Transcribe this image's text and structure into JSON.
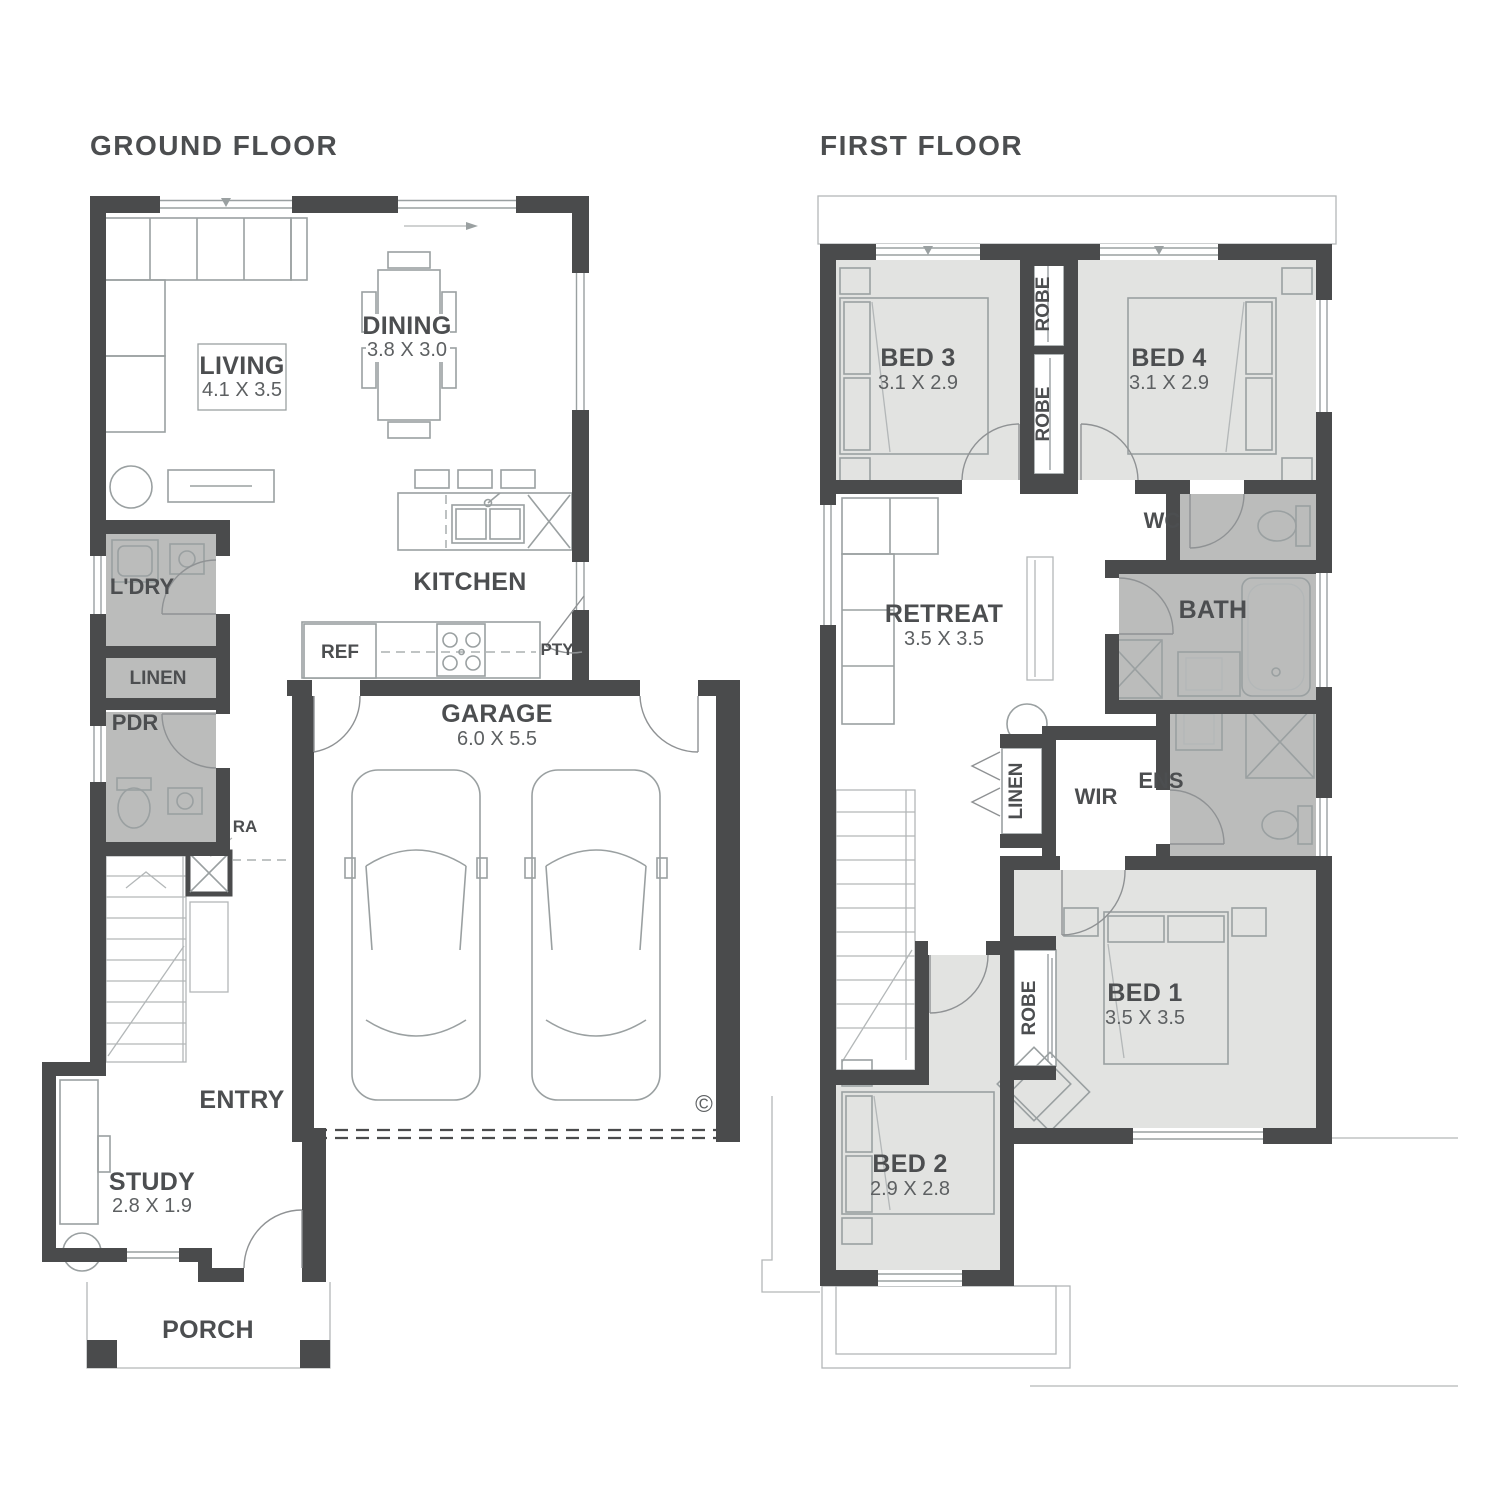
{
  "palette": {
    "wall": "#4a4b4c",
    "room-light": "#e2e3e1",
    "room-wet": "#bbbcbb",
    "line": "#9aa0a1",
    "thin": "#b3b7b8",
    "door": "#8f9294",
    "text": "#4c4e50",
    "text-light": "#5d6062",
    "bg": "#ffffff"
  },
  "ground_floor": {
    "title": "GROUND FLOOR",
    "rooms": {
      "living": {
        "name": "LIVING",
        "dims": "4.1 X 3.5"
      },
      "dining": {
        "name": "DINING",
        "dims": "3.8 X 3.0"
      },
      "kitchen": {
        "name": "KITCHEN"
      },
      "laundry": {
        "name": "L'DRY"
      },
      "linen": {
        "name": "LINEN"
      },
      "powder": {
        "name": "PDR"
      },
      "return_air": {
        "name": "RA"
      },
      "fridge": {
        "name": "REF"
      },
      "pantry": {
        "name": "PTY"
      },
      "garage": {
        "name": "GARAGE",
        "dims": "6.0 X 5.5"
      },
      "entry": {
        "name": "ENTRY"
      },
      "study": {
        "name": "STUDY",
        "dims": "2.8 X 1.9"
      },
      "porch": {
        "name": "PORCH"
      }
    },
    "copyright_mark": "©"
  },
  "first_floor": {
    "title": "FIRST FLOOR",
    "rooms": {
      "bed3": {
        "name": "BED 3",
        "dims": "3.1 X 2.9"
      },
      "bed4": {
        "name": "BED 4",
        "dims": "3.1 X 2.9"
      },
      "robe_bed3": {
        "name": "ROBE"
      },
      "robe_bed4": {
        "name": "ROBE"
      },
      "wc": {
        "name": "WC"
      },
      "bath": {
        "name": "BATH"
      },
      "retreat": {
        "name": "RETREAT",
        "dims": "3.5 X 3.5"
      },
      "linen": {
        "name": "LINEN"
      },
      "wir": {
        "name": "WIR"
      },
      "ens": {
        "name": "ENS"
      },
      "bed1": {
        "name": "BED 1",
        "dims": "3.5 X 3.5"
      },
      "robe_bed1": {
        "name": "ROBE"
      },
      "bed2": {
        "name": "BED 2",
        "dims": "2.9 X 2.8"
      }
    }
  }
}
